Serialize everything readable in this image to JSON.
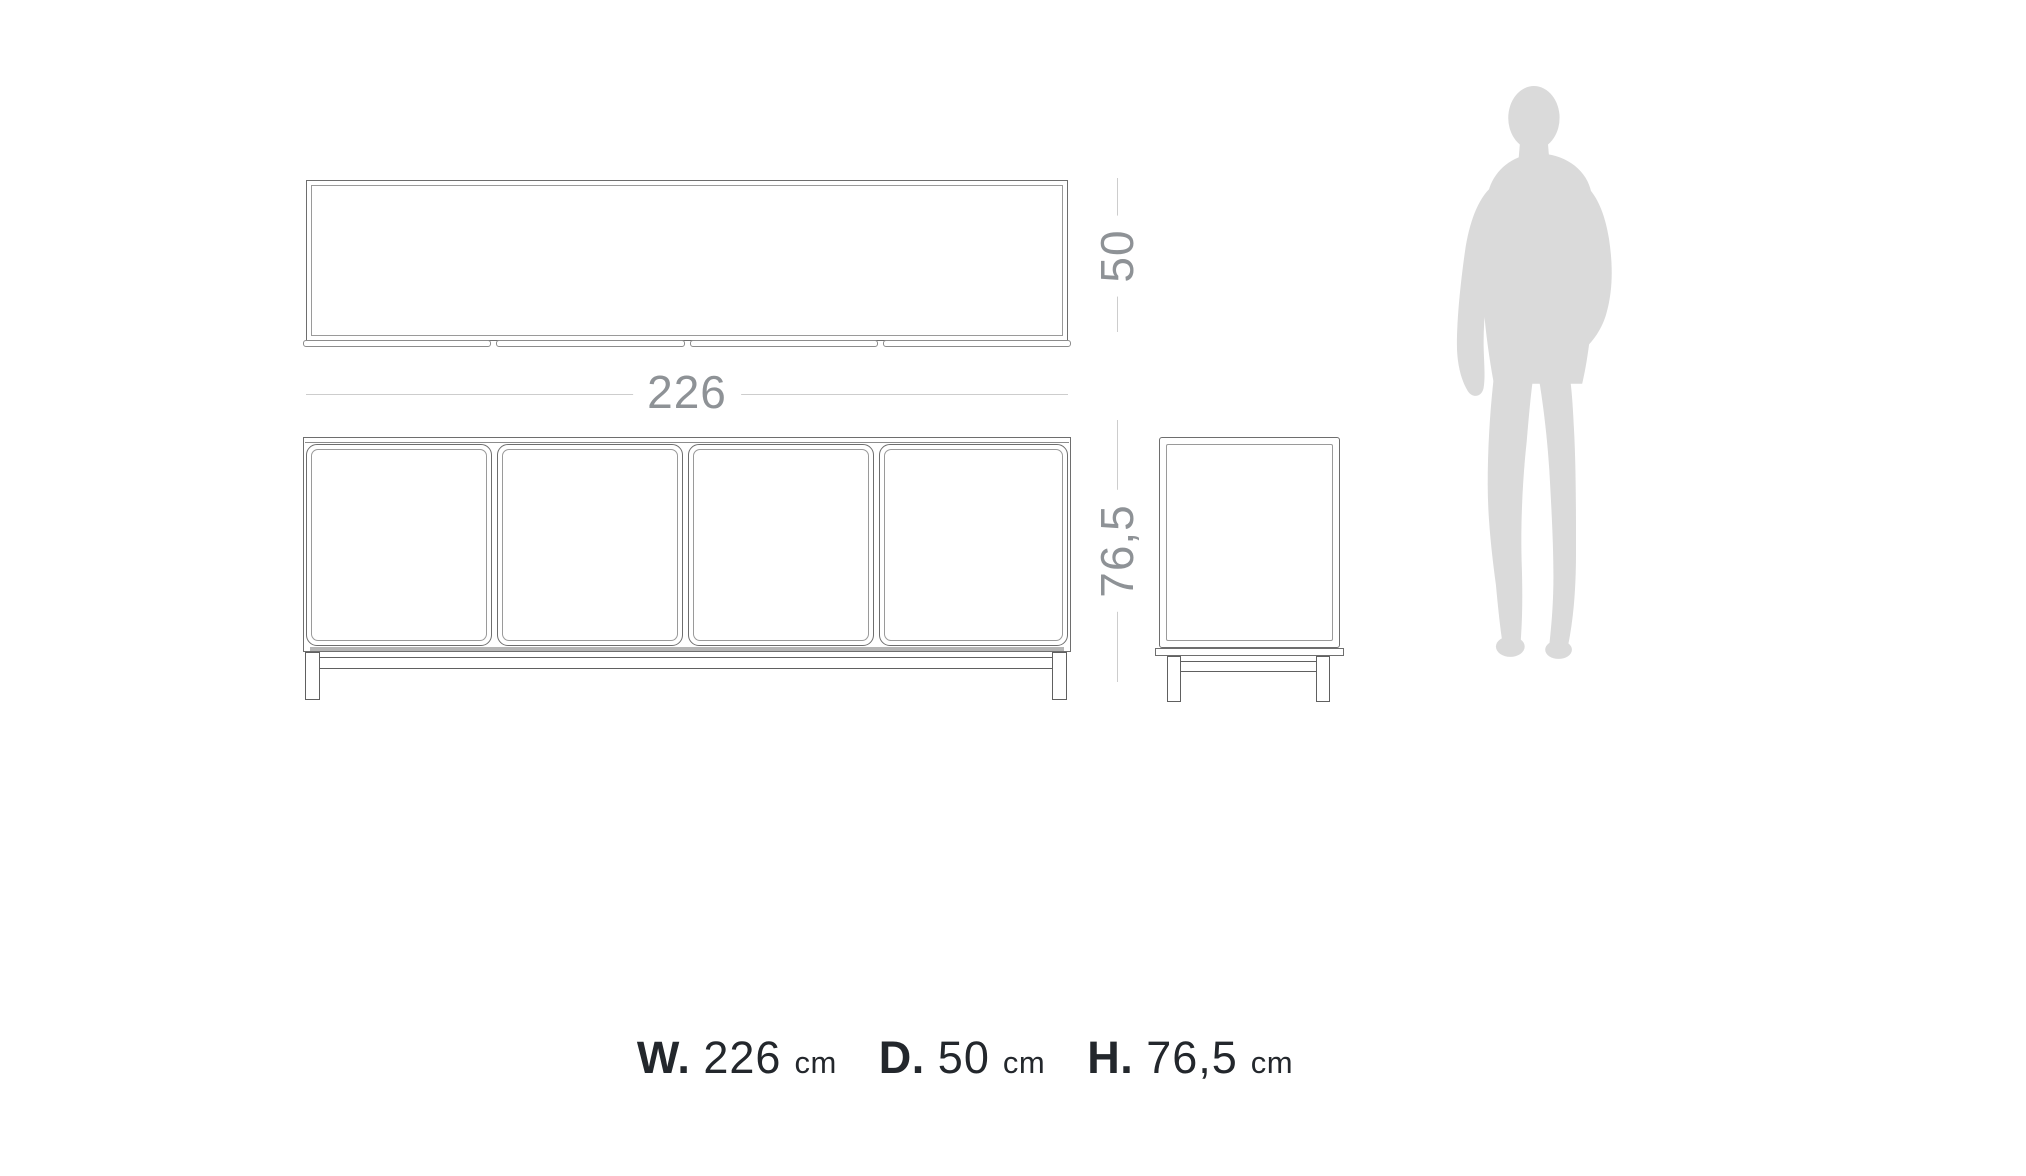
{
  "diagram": {
    "dims": {
      "width": "226",
      "depth": "50",
      "height": "76,5"
    }
  },
  "summary": {
    "items": [
      {
        "prefix": "W.",
        "value": "226",
        "unit": "cm"
      },
      {
        "prefix": "D.",
        "value": "50",
        "unit": "cm"
      },
      {
        "prefix": "H.",
        "value": "76,5",
        "unit": "cm"
      }
    ]
  },
  "colors": {
    "background": "#ffffff",
    "outline": "#6e6e6e",
    "outline_soft": "#9a9a9a",
    "dimension_line": "#cdcdcd",
    "dimension_text": "#8e9296",
    "shadow": "#b5b5b5",
    "summary_text": "#23272c",
    "silhouette": "#dadada"
  }
}
